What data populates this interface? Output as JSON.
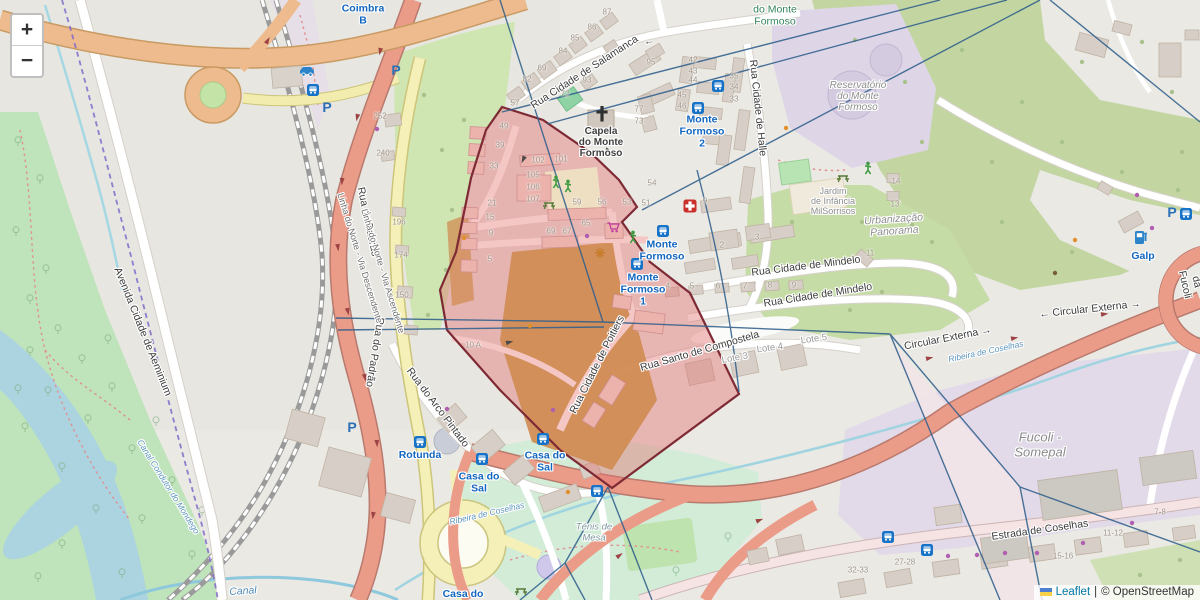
{
  "map": {
    "controls": {
      "zoom_in": "+",
      "zoom_out": "−"
    },
    "attribution": {
      "leaflet": "Leaflet",
      "separator": "|",
      "copyright": "© OpenStreetMap"
    },
    "colors": {
      "selection_fill": "#e26e6e",
      "selection_border": "#7e2a35",
      "mesh_line": "#31608c",
      "admin_boundary": "#8068c8",
      "road_trunk": "#eb9c89",
      "road_secondary": "#f4f0b8",
      "water": "#abd4e0",
      "forest": "#c3d6a2",
      "transit_blue": "#1266c0"
    },
    "labels": [
      {
        "n": "street-rua-cidade-de-salamanca",
        "t": "Rua Cidade de Salamanca",
        "x": 585,
        "y": 73,
        "r": -33,
        "c": "street"
      },
      {
        "n": "oneway-arrow-salamanca",
        "t": "←",
        "x": 649,
        "y": 42,
        "r": -10,
        "c": "street"
      },
      {
        "n": "street-rua-cidade-de-halle",
        "t": "Rua Cidade de Halle",
        "x": 757,
        "y": 108,
        "r": 84,
        "c": "street"
      },
      {
        "n": "street-rua-do-padrao-1",
        "t": "Rua do Padrão",
        "x": 367,
        "y": 222,
        "r": 78,
        "c": "street"
      },
      {
        "n": "street-rua-do-padrao-2",
        "t": "Rua do Padrão",
        "x": 374,
        "y": 352,
        "r": 99,
        "c": "street"
      },
      {
        "n": "street-rua-do-arco-pintado",
        "t": "Rua do Arco Pintado",
        "x": 437,
        "y": 408,
        "r": 53,
        "c": "street"
      },
      {
        "n": "street-avenida-cidade-de-aeminium",
        "t": "Avenida Cidade de Aeminium",
        "x": 142,
        "y": 332,
        "r": 68,
        "c": "street"
      },
      {
        "n": "rail-linha-do-norte-descendente",
        "t": "Linha do Norte - Via Descendente",
        "x": 360,
        "y": 258,
        "r": 73,
        "c": "rail"
      },
      {
        "n": "rail-linha-do-norte-ascendente",
        "t": "Linha do Norte - Via Ascendente",
        "x": 383,
        "y": 271,
        "r": 73,
        "c": "rail"
      },
      {
        "n": "street-rua-cidade-de-poitiers",
        "t": "Rua Cidade de Poitiers",
        "x": 598,
        "y": 365,
        "r": -63,
        "c": "street"
      },
      {
        "n": "street-rua-santo-de-compostela",
        "t": "Rua Santo de Compostela",
        "x": 700,
        "y": 352,
        "r": -16,
        "c": "street"
      },
      {
        "n": "street-rua-cidade-de-mindelo-1",
        "t": "Rua Cidade de Mindelo",
        "x": 806,
        "y": 267,
        "r": -7,
        "c": "street"
      },
      {
        "n": "street-rua-cidade-de-mindelo-2",
        "t": "Rua Cidade de Mindelo",
        "x": 818,
        "y": 296,
        "r": -9,
        "c": "street"
      },
      {
        "n": "street-circular-externa-1",
        "t": "Circular Externa →",
        "x": 948,
        "y": 339,
        "r": -11,
        "c": "street"
      },
      {
        "n": "street-circular-externa-2",
        "t": "← Circular Externa →",
        "x": 1090,
        "y": 310,
        "r": -6,
        "c": "street"
      },
      {
        "n": "street-estrada-de-coselhas",
        "t": "Estrada de Coselhas",
        "x": 1040,
        "y": 531,
        "r": -8,
        "c": "street"
      },
      {
        "n": "street-rotunda-da-fucoli",
        "t": "Rotunda da Fucoli",
        "x": 1196,
        "y": 282,
        "r": 77,
        "c": "street"
      },
      {
        "n": "water-ribeira-de-coselhas-1",
        "t": "Ribeira de Coselhas",
        "x": 986,
        "y": 352,
        "r": -12,
        "c": "water-sm"
      },
      {
        "n": "water-ribeira-de-coselhas-2",
        "t": "Ribeira de Coselhas",
        "x": 487,
        "y": 514,
        "r": -13,
        "c": "water-sm"
      },
      {
        "n": "water-canal",
        "t": "Canal",
        "x": 243,
        "y": 592,
        "r": -4,
        "c": "water"
      },
      {
        "n": "water-canal-condutor",
        "t": "Canal Condutor do Mondego",
        "x": 168,
        "y": 487,
        "r": 58,
        "c": "water-sm"
      },
      {
        "n": "station-coimbra-b",
        "t": "Coimbra\nB",
        "x": 363,
        "y": 15,
        "r": 0,
        "c": "transit"
      },
      {
        "n": "stop-monte-formoso-2",
        "t": "Monte\nFormoso\n2",
        "x": 702,
        "y": 132,
        "r": 0,
        "c": "transit"
      },
      {
        "n": "stop-monte-formoso",
        "t": "Monte\nFormoso",
        "x": 662,
        "y": 251,
        "r": 0,
        "c": "transit"
      },
      {
        "n": "stop-monte-formoso-1",
        "t": "Monte\nFormoso\n1",
        "x": 643,
        "y": 290,
        "r": 0,
        "c": "transit"
      },
      {
        "n": "stop-casa-do-sal-1",
        "t": "Casa do\nSal",
        "x": 545,
        "y": 462,
        "r": 0,
        "c": "transit"
      },
      {
        "n": "stop-casa-do-sal-2",
        "t": "Casa do\nSal",
        "x": 479,
        "y": 483,
        "r": 0,
        "c": "transit"
      },
      {
        "n": "stop-rotunda",
        "t": "Rotunda",
        "x": 420,
        "y": 456,
        "r": 0,
        "c": "transit"
      },
      {
        "n": "stop-casa-do",
        "t": "Casa do",
        "x": 463,
        "y": 595,
        "r": 0,
        "c": "transit"
      },
      {
        "n": "poi-galp",
        "t": "Galp",
        "x": 1143,
        "y": 257,
        "r": 0,
        "c": "transit"
      },
      {
        "n": "poi-capela-do-monte-formoso",
        "t": "Capela\ndo Monte\nFormoso",
        "x": 601,
        "y": 143,
        "r": 0,
        "c": "poi"
      },
      {
        "n": "area-reservatorio-do-monte-formoso",
        "t": "Reservatório\ndo Monte\nFormoso",
        "x": 858,
        "y": 97,
        "r": 0,
        "c": "area"
      },
      {
        "n": "area-parque-do-monte-formoso",
        "t": "do Monte\nFormoso",
        "x": 775,
        "y": 16,
        "r": 0,
        "c": "green"
      },
      {
        "n": "area-jardim-de-infancia-milsorrisos",
        "t": "Jardim\nde Infância\nMilSorrisos",
        "x": 833,
        "y": 201,
        "r": 0,
        "c": "area-sm"
      },
      {
        "n": "area-urbanizacao-panorama",
        "t": "Urbanização\nPanorama",
        "x": 894,
        "y": 226,
        "r": -4,
        "c": "area-it"
      },
      {
        "n": "area-fucoli-somepal",
        "t": "Fucoli -\nSomepal",
        "x": 1040,
        "y": 445,
        "r": 0,
        "c": "area-lg"
      },
      {
        "n": "area-tenis-de-mesa",
        "t": "Ténis de\nMesa",
        "x": 594,
        "y": 533,
        "r": 0,
        "c": "area-it-sm"
      },
      {
        "n": "lot-lote-3",
        "t": "Lote 3",
        "x": 735,
        "y": 359,
        "r": -10,
        "c": "lot"
      },
      {
        "n": "lot-lote-4",
        "t": "Lote 4",
        "x": 770,
        "y": 349,
        "r": -8,
        "c": "lot"
      },
      {
        "n": "lot-lote-5",
        "t": "Lote 5",
        "x": 814,
        "y": 340,
        "r": -8,
        "c": "lot"
      }
    ],
    "house_numbers": [
      {
        "t": "87",
        "x": 607,
        "y": 13
      },
      {
        "t": "86",
        "x": 592,
        "y": 28
      },
      {
        "t": "85",
        "x": 575,
        "y": 39
      },
      {
        "t": "84",
        "x": 563,
        "y": 52
      },
      {
        "t": "69",
        "x": 542,
        "y": 69
      },
      {
        "t": "82",
        "x": 527,
        "y": 80
      },
      {
        "t": "93",
        "x": 587,
        "y": 81
      },
      {
        "t": "72",
        "x": 565,
        "y": 95
      },
      {
        "t": "57",
        "x": 515,
        "y": 104
      },
      {
        "t": "95",
        "x": 651,
        "y": 63
      },
      {
        "t": "42",
        "x": 693,
        "y": 61
      },
      {
        "t": "43",
        "x": 693,
        "y": 72
      },
      {
        "t": "44",
        "x": 693,
        "y": 81
      },
      {
        "t": "45",
        "x": 682,
        "y": 96
      },
      {
        "t": "46",
        "x": 682,
        "y": 107
      },
      {
        "t": "77",
        "x": 639,
        "y": 110
      },
      {
        "t": "73",
        "x": 639,
        "y": 122
      },
      {
        "t": "35",
        "x": 734,
        "y": 77
      },
      {
        "t": "34",
        "x": 734,
        "y": 88
      },
      {
        "t": "33",
        "x": 734,
        "y": 100
      },
      {
        "t": "252",
        "x": 380,
        "y": 117
      },
      {
        "t": "240",
        "x": 383,
        "y": 154
      },
      {
        "t": "196",
        "x": 399,
        "y": 223
      },
      {
        "t": "174",
        "x": 401,
        "y": 256
      },
      {
        "t": "150",
        "x": 402,
        "y": 296
      },
      {
        "t": "10 A",
        "x": 473,
        "y": 346
      },
      {
        "t": "49",
        "x": 504,
        "y": 127
      },
      {
        "t": "39",
        "x": 500,
        "y": 146
      },
      {
        "t": "33",
        "x": 494,
        "y": 167
      },
      {
        "t": "102",
        "x": 538,
        "y": 161
      },
      {
        "t": "101",
        "x": 561,
        "y": 160
      },
      {
        "t": "105",
        "x": 533,
        "y": 176
      },
      {
        "t": "106",
        "x": 533,
        "y": 188
      },
      {
        "t": "107",
        "x": 533,
        "y": 200
      },
      {
        "t": "21",
        "x": 492,
        "y": 204
      },
      {
        "t": "15",
        "x": 490,
        "y": 218
      },
      {
        "t": "9",
        "x": 491,
        "y": 234
      },
      {
        "t": "5",
        "x": 490,
        "y": 260
      },
      {
        "t": "69",
        "x": 551,
        "y": 232
      },
      {
        "t": "67",
        "x": 567,
        "y": 232
      },
      {
        "t": "65",
        "x": 586,
        "y": 224
      },
      {
        "t": "59",
        "x": 577,
        "y": 203
      },
      {
        "t": "56",
        "x": 602,
        "y": 203
      },
      {
        "t": "53",
        "x": 627,
        "y": 203
      },
      {
        "t": "51",
        "x": 646,
        "y": 204
      },
      {
        "t": "54",
        "x": 652,
        "y": 184
      },
      {
        "t": "9",
        "x": 705,
        "y": 202
      },
      {
        "t": "2",
        "x": 722,
        "y": 246
      },
      {
        "t": "3",
        "x": 757,
        "y": 238
      },
      {
        "t": "4",
        "x": 668,
        "y": 287
      },
      {
        "t": "5",
        "x": 692,
        "y": 287
      },
      {
        "t": "6",
        "x": 718,
        "y": 287
      },
      {
        "t": "7",
        "x": 745,
        "y": 287
      },
      {
        "t": "8",
        "x": 770,
        "y": 286
      },
      {
        "t": "9",
        "x": 794,
        "y": 286
      },
      {
        "t": "11",
        "x": 870,
        "y": 254
      },
      {
        "t": "13",
        "x": 895,
        "y": 205
      },
      {
        "t": "14",
        "x": 896,
        "y": 182
      },
      {
        "t": "32-33",
        "x": 858,
        "y": 571
      },
      {
        "t": "27-28",
        "x": 905,
        "y": 563
      },
      {
        "t": "15-16",
        "x": 1063,
        "y": 557
      },
      {
        "t": "11-12",
        "x": 1113,
        "y": 534
      },
      {
        "t": "7-8",
        "x": 1160,
        "y": 513
      }
    ]
  }
}
